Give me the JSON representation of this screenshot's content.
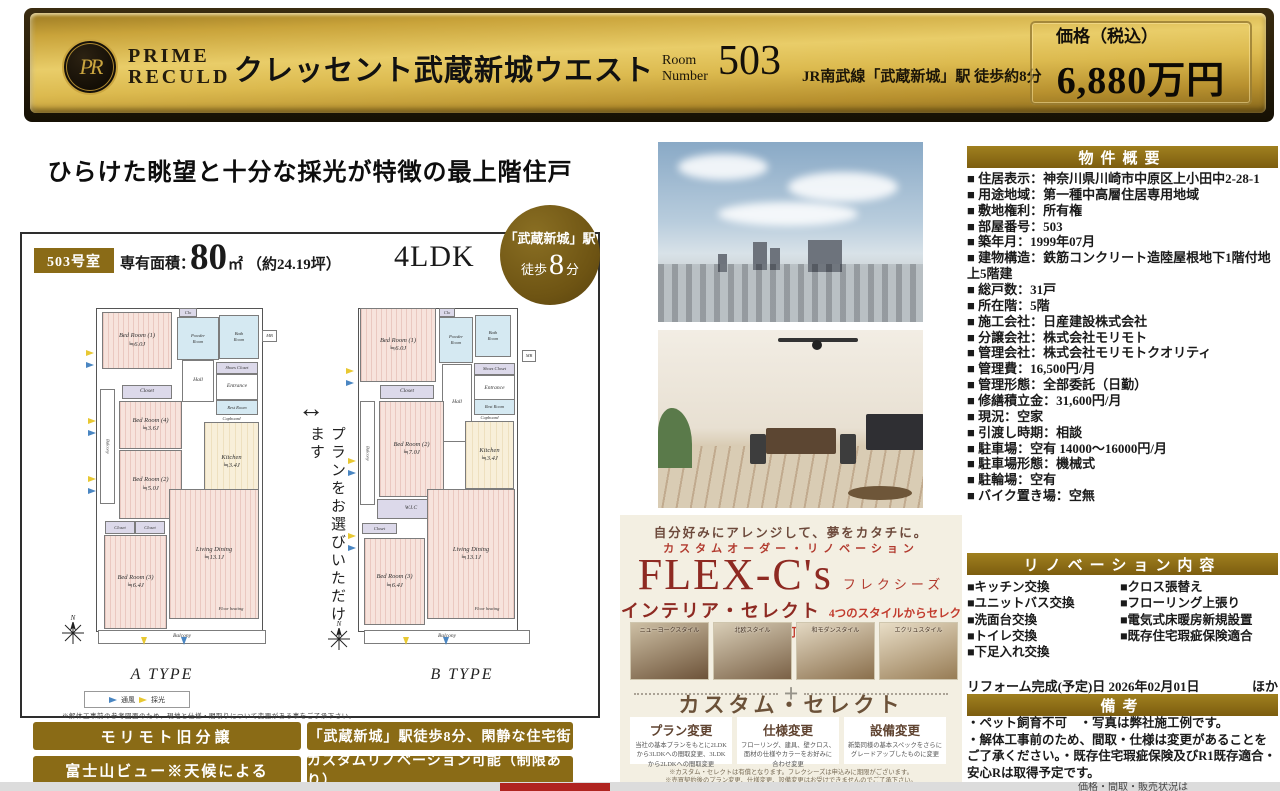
{
  "banner": {
    "monogram": "PR",
    "logo_top": "PRIME",
    "logo_bottom": "RECULD",
    "title": "クレッセント武蔵新城ウエスト",
    "room_label_top": "Room",
    "room_label_bottom": "Number",
    "room_number": "503",
    "station": "JR南武線「武蔵新城」駅 徒歩約8分",
    "price_label": "価格（税込）",
    "price": "6,880万円"
  },
  "headline": "ひらけた眺望と十分な採光が特徴の最上階住戸",
  "unit": {
    "room_badge": "503号室",
    "area_label": "専有面積：",
    "area_value": "80",
    "area_unit": "㎡",
    "area_tsubo": "（約24.19坪）",
    "layout": "4LDK"
  },
  "station_badge": {
    "line1": "「武蔵新城」駅",
    "walk": "徒歩",
    "minutes": "8",
    "unit": "分"
  },
  "plan_select": {
    "arrow": "↔",
    "text": "プランをお選びいただけます"
  },
  "floorplans": {
    "a": {
      "name": "A TYPE",
      "rooms": [
        {
          "label": "Bed Room (1)\n≒6.0J"
        },
        {
          "label": "Clo"
        },
        {
          "label": "Powder\nRoom"
        },
        {
          "label": "Bath\nRoom"
        },
        {
          "label": "MB"
        },
        {
          "label": "Hall"
        },
        {
          "label": "Shoes Closet"
        },
        {
          "label": "Entrance"
        },
        {
          "label": "Closet"
        },
        {
          "label": "Bed Room (4)\n≒3.6J"
        },
        {
          "label": "Rest Room"
        },
        {
          "label": "Cupboard"
        },
        {
          "label": "Kitchen\n≒3.4J"
        },
        {
          "label": "Bed Room (2)\n≒5.0J"
        },
        {
          "label": "Closet"
        },
        {
          "label": "Closet"
        },
        {
          "label": "Bed Room (3)\n≒6.4J"
        },
        {
          "label": "Living Dining\n≒13.1J"
        },
        {
          "label": "Floor heating"
        },
        {
          "label": "Balcony"
        },
        {
          "label": "Balcony"
        }
      ]
    },
    "b": {
      "name": "B TYPE",
      "rooms": [
        {
          "label": "Bed Room (1)\n≒6.0J"
        },
        {
          "label": "Clo"
        },
        {
          "label": "Powder\nRoom"
        },
        {
          "label": "Bath\nRoom"
        },
        {
          "label": "MB"
        },
        {
          "label": "Hall"
        },
        {
          "label": "Shoes Closet"
        },
        {
          "label": "Entrance"
        },
        {
          "label": "Rest Room"
        },
        {
          "label": "Closet"
        },
        {
          "label": "Bed Room (2)\n≒7.0J"
        },
        {
          "label": "Cupboard"
        },
        {
          "label": "Kitchen\n≒3.4J"
        },
        {
          "label": "W.I.C"
        },
        {
          "label": "Closet"
        },
        {
          "label": "Bed Room (3)\n≒6.4J"
        },
        {
          "label": "Living Dining\n≒13.1J"
        },
        {
          "label": "Floor heating"
        },
        {
          "label": "Balcony"
        },
        {
          "label": "Balcony"
        }
      ]
    },
    "legend": {
      "wind": "通風",
      "light": "採光"
    },
    "note": "※解体工事前の参考図面のため、現地と仕様・間取りについて変更がある事をご了承下さい。",
    "compass_n": "N"
  },
  "feature_buttons": [
    "モリモト旧分譲",
    "「武蔵新城」駅徒歩8分、閑静な住宅街",
    "富士山ビュー※天候による",
    "カスタムリノベーション可能（制限あり）"
  ],
  "flex": {
    "catch": "自分好みにアレンジして、夢をカタチに。",
    "subtitle": "カスタムオーダー・リノベーション",
    "brand": "FLEX-C's",
    "brand_kana": "フレクシーズ",
    "select_title": "インテリア・セレクト",
    "select_sub": "4つのスタイルからセレクト可能",
    "styles": [
      "ニューヨークスタイル",
      "北欧スタイル",
      "和モダンスタイル",
      "エクリュスタイル"
    ],
    "plus": "+",
    "custom_title": "カスタム・セレクト",
    "cards": [
      {
        "title": "プラン変更",
        "desc": "当社の基本プランをもとに2LDKから3LDKへの間取変更、3LDKから2LDKへの間取変更"
      },
      {
        "title": "仕様変更",
        "desc": "フローリング、建具、壁クロス、面材の仕様やカラーをお好みに合わせ変更"
      },
      {
        "title": "設備変更",
        "desc": "新築同様の基本スペックをさらにグレードアップしたものに変更"
      }
    ],
    "notes": [
      "※カスタム・セレクトは有償となります。フレクシーズは申込みに期限がございます。",
      "※売買契約後のプラン変更、仕様変更、設備変更はお受けできませんのでご了承下さい。"
    ]
  },
  "overview": {
    "title": "物件概要",
    "items": [
      "■ 住居表示：神奈川県川崎市中原区上小田中2-28-1",
      "■ 用途地域：第一種中高層住居専用地域",
      "■ 敷地権利：所有権",
      "■ 部屋番号：503",
      "■ 築年月：1999年07月",
      "■ 建物構造：鉄筋コンクリート造陸屋根地下1階付地上5階建",
      "■ 総戸数：31戸",
      "■ 所在階：5階",
      "■ 施工会社：日産建設株式会社",
      "■ 分譲会社：株式会社モリモト",
      "■ 管理会社：株式会社モリモトクオリティ",
      "■ 管理費：16,500円/月",
      "■ 管理形態：全部委託（日勤）",
      "■ 修繕積立金：31,600円/月",
      "■ 現況：空家",
      "■ 引渡し時期：相談",
      "■ 駐車場：空有 14000～16000円/月",
      "■ 駐車場形態：機械式",
      "■ 駐輪場：空有",
      "■ バイク置き場：空無"
    ]
  },
  "renovation": {
    "title": "リノベーション内容",
    "left": [
      "■キッチン交換",
      "■ユニットバス交換",
      "■洗面台交換",
      "■トイレ交換",
      "■下足入れ交換"
    ],
    "right": [
      "■クロス張替え",
      "■フローリング上張り",
      "■電気式床暖房新規設置",
      "■既存住宅瑕疵保険適合"
    ]
  },
  "reform": {
    "date_line": "リフォーム完成(予定)日 2026年02月01日",
    "extra": "ほか"
  },
  "remarks": {
    "title": "備考",
    "lines": [
      "・ペット飼育不可　・写真は弊社施工例です。",
      "・解体工事前のため、間取・仕様は変更があることをご了承ください。・既存住宅瑕疵保険及びR1既存適合・安心Rは取得予定です。"
    ]
  },
  "footer": {
    "fragment": "価格・間取・販売状況は"
  }
}
